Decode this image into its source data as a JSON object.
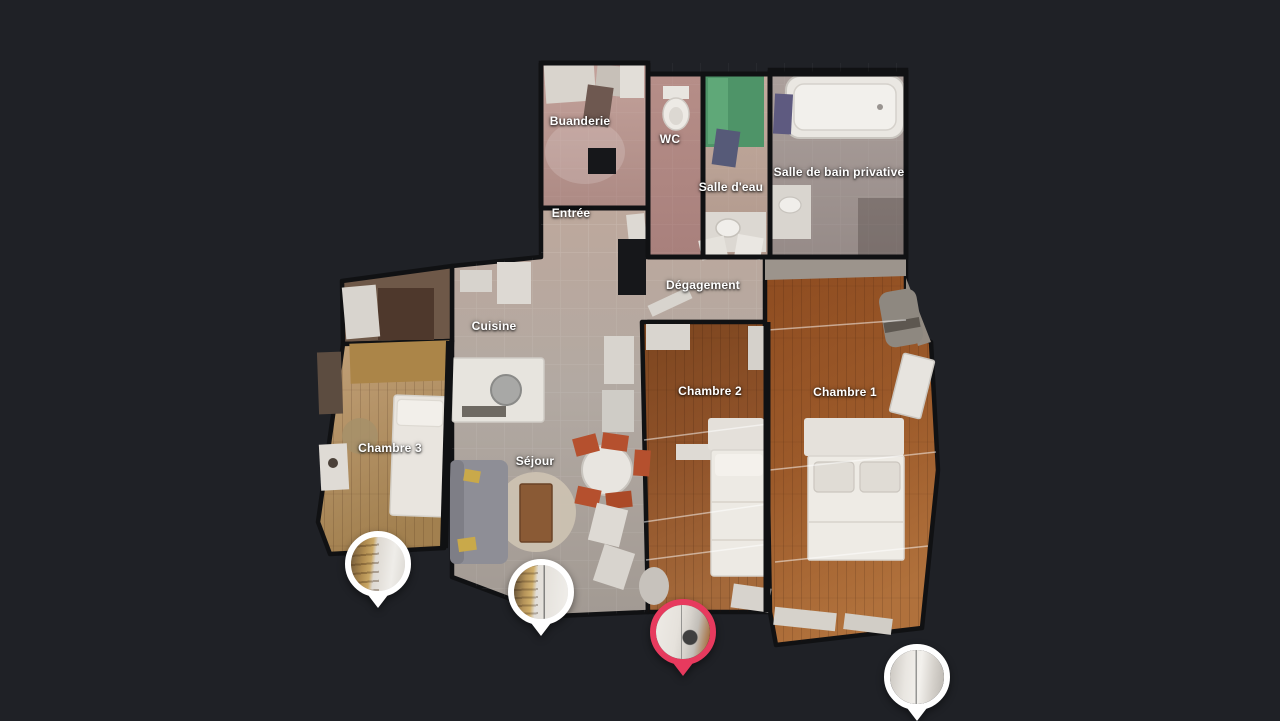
{
  "colors": {
    "background": "#1f2126",
    "pin_active": "#e73a5e",
    "pin_inactive": "#ffffff",
    "label_text": "#ffffff"
  },
  "rooms": [
    {
      "id": "buanderie",
      "label": "Buanderie",
      "x": 580,
      "y": 121
    },
    {
      "id": "wc",
      "label": "WC",
      "x": 670,
      "y": 139
    },
    {
      "id": "salle-deau",
      "label": "Salle d'eau",
      "x": 731,
      "y": 187
    },
    {
      "id": "salle-de-bain-privative",
      "label": "Salle de bain privative",
      "x": 839,
      "y": 172
    },
    {
      "id": "entree",
      "label": "Entrée",
      "x": 571,
      "y": 213
    },
    {
      "id": "degagement",
      "label": "Dégagement",
      "x": 703,
      "y": 285
    },
    {
      "id": "cuisine",
      "label": "Cuisine",
      "x": 494,
      "y": 326
    },
    {
      "id": "chambre-3",
      "label": "Chambre 3",
      "x": 390,
      "y": 448
    },
    {
      "id": "sejour",
      "label": "Séjour",
      "x": 535,
      "y": 461
    },
    {
      "id": "chambre-2",
      "label": "Chambre 2",
      "x": 710,
      "y": 391
    },
    {
      "id": "chambre-1",
      "label": "Chambre 1",
      "x": 845,
      "y": 392
    }
  ],
  "pins": [
    {
      "id": "pin-1",
      "x": 378,
      "y": 608,
      "active": false
    },
    {
      "id": "pin-2",
      "x": 541,
      "y": 636,
      "active": false
    },
    {
      "id": "pin-3",
      "x": 683,
      "y": 676,
      "active": true
    },
    {
      "id": "pin-4",
      "x": 917,
      "y": 721,
      "active": false
    }
  ]
}
